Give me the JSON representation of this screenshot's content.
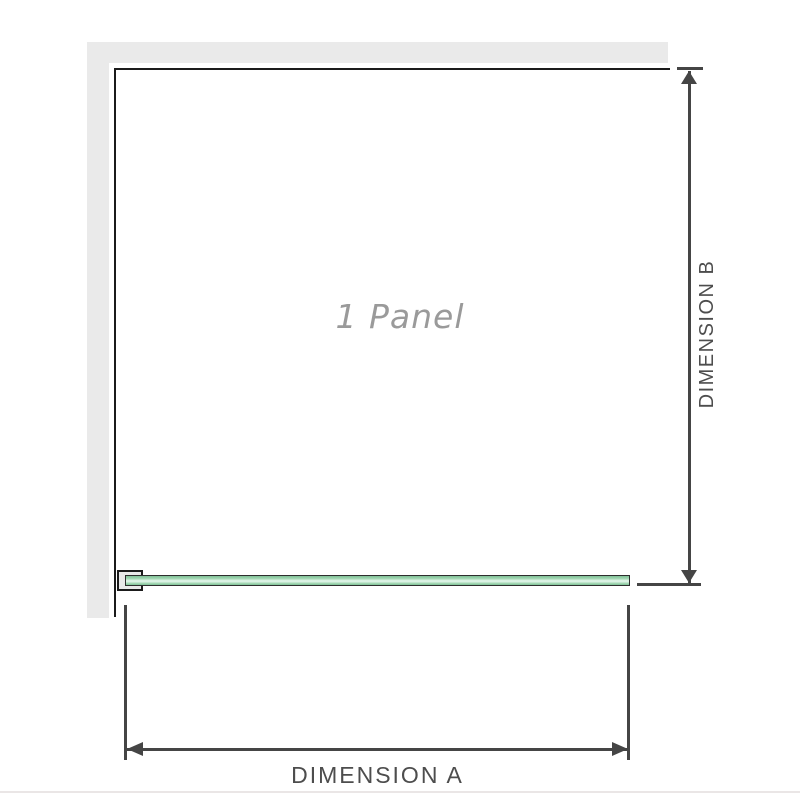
{
  "diagram": {
    "panel_label": "1 Panel",
    "dimension_a_label": "DIMENSION A",
    "dimension_b_label": "DIMENSION B"
  },
  "colors": {
    "canvas-bg": "#ffffff",
    "wall": "#eaeaea",
    "outline": "#1b1b1b",
    "dim-line": "#454545",
    "dim-text": "#4d4d4d",
    "panel-text": "#9a9a9a",
    "glass-border": "#2e2e2e",
    "glass-dark": "#7fc096",
    "glass-mid": "#a3d8b4",
    "glass-light": "#def3e6",
    "bracket-fill": "#e9e9e9",
    "divider": "#eae6e6"
  }
}
